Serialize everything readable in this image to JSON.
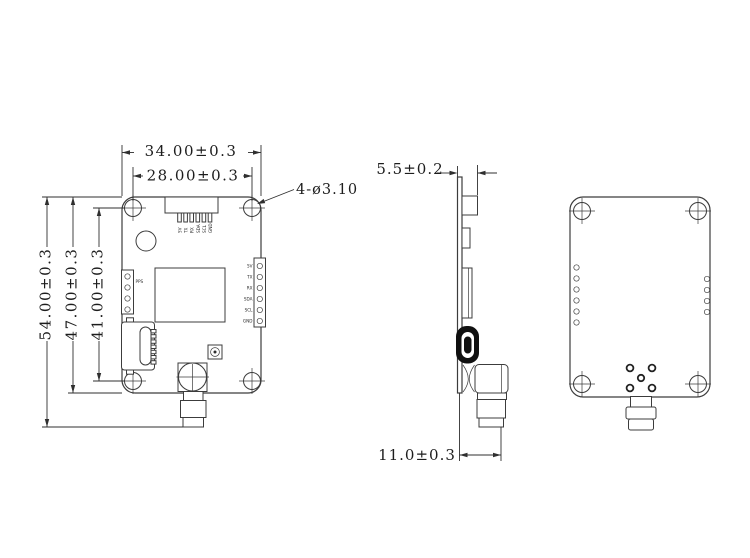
{
  "drawing_type": "PCB module 3-view dimensional drawing",
  "dimensions": {
    "width_overall": "34.00±0.3",
    "width_hole_spacing": "28.00±0.3",
    "hole_callout": "4-ø3.10",
    "height_overall": "54.00±0.3",
    "height_board": "47.00±0.3",
    "height_hole_spacing": "41.00±0.3",
    "side_thickness": "5.5±0.2",
    "sma_connector_length": "11.0±0.3"
  },
  "labels": {
    "pps": "PPS"
  },
  "pins": [
    "5V",
    "TX",
    "RX",
    "SDA",
    "SCL",
    "GND"
  ],
  "colors": {
    "background": "#ffffff",
    "line": "#3c3c3c",
    "dimension_line": "#2f2f2f",
    "usb_body": "#101010"
  }
}
